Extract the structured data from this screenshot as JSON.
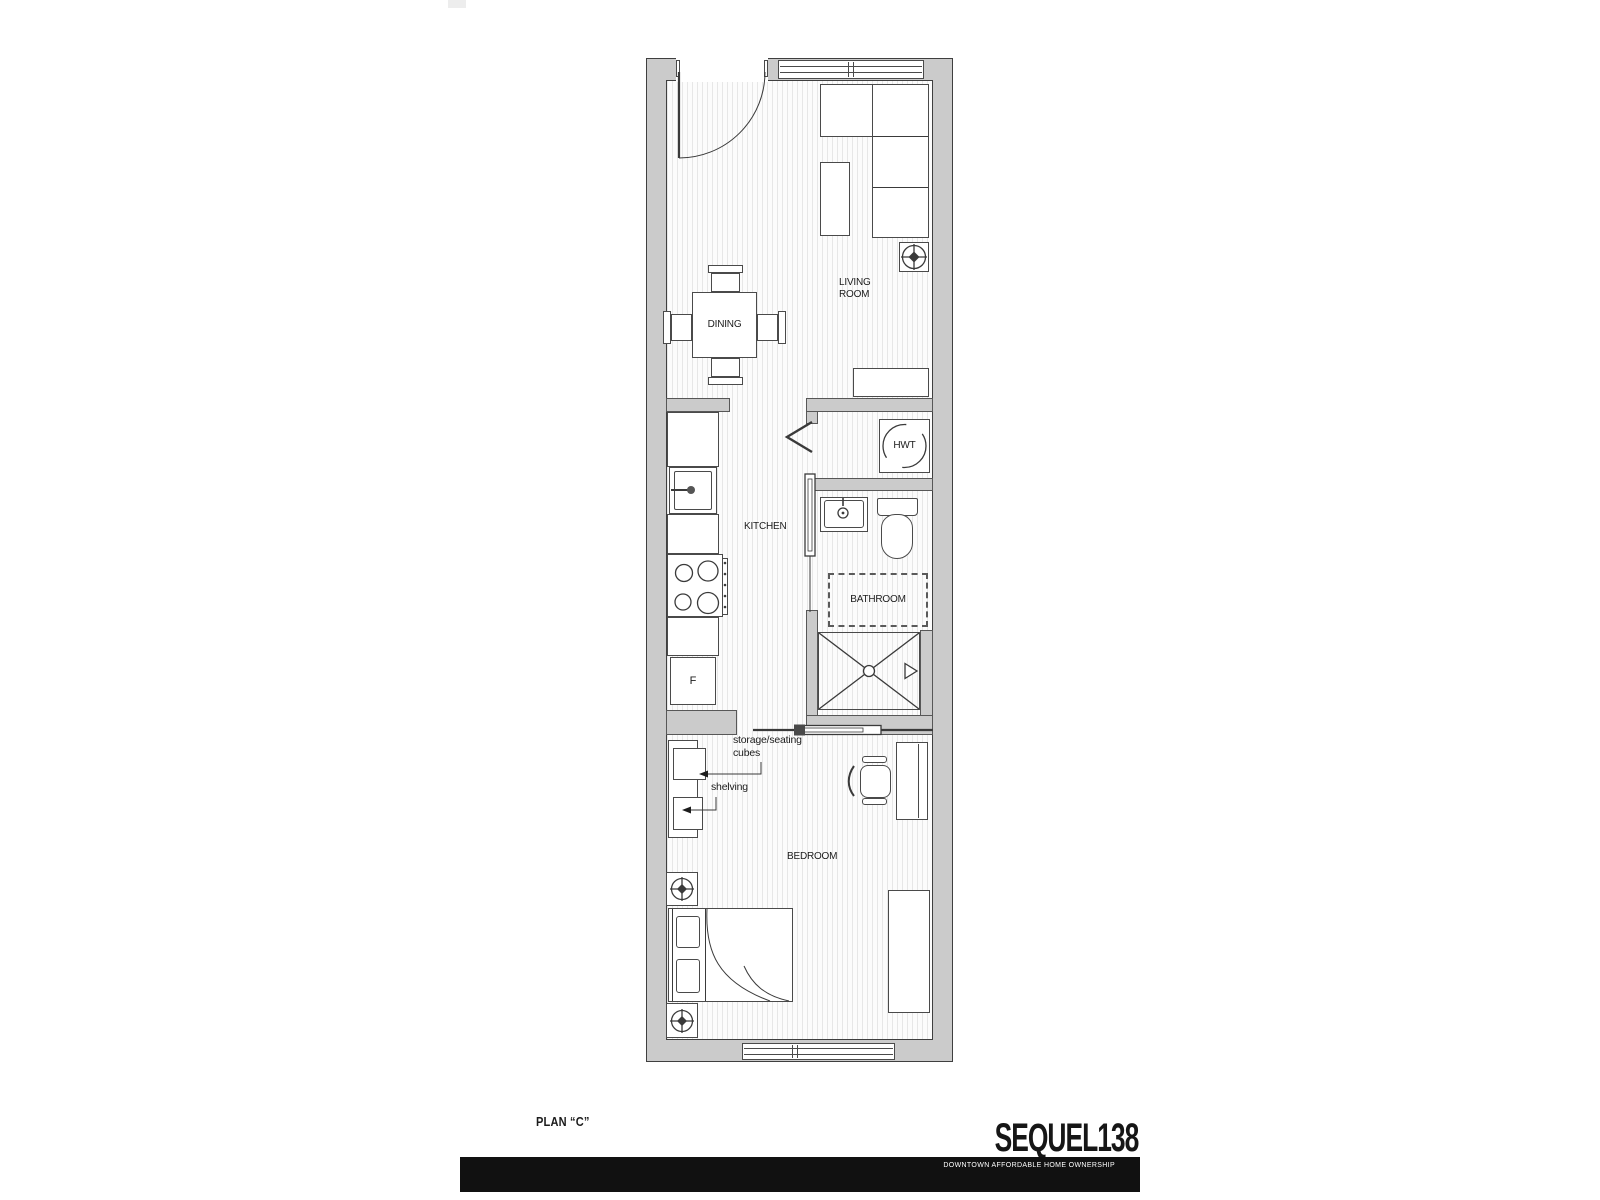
{
  "title_block": {
    "plan_title": "PLAN “C”",
    "logo": "SEQUEL138",
    "tagline": "DOWNTOWN AFFORDABLE HOME OWNERSHIP"
  },
  "rooms": {
    "living_room": "LIVING\nROOM",
    "dining": "DINING",
    "kitchen": "KITCHEN",
    "bathroom": "BATHROOM",
    "bedroom": "BEDROOM",
    "hwt": "HWT",
    "fridge": "F"
  },
  "annotations": {
    "storage_cubes": "storage/seating\ncubes",
    "shelving": "shelving"
  },
  "colors": {
    "wall_fill": "#cbcbcb",
    "wall_outline": "#3f3f3f",
    "furniture_outline": "#4a4a4a",
    "floor_stripe": "#e7e7e7",
    "brand_bar": "#111111",
    "text": "#1c1c1c"
  }
}
